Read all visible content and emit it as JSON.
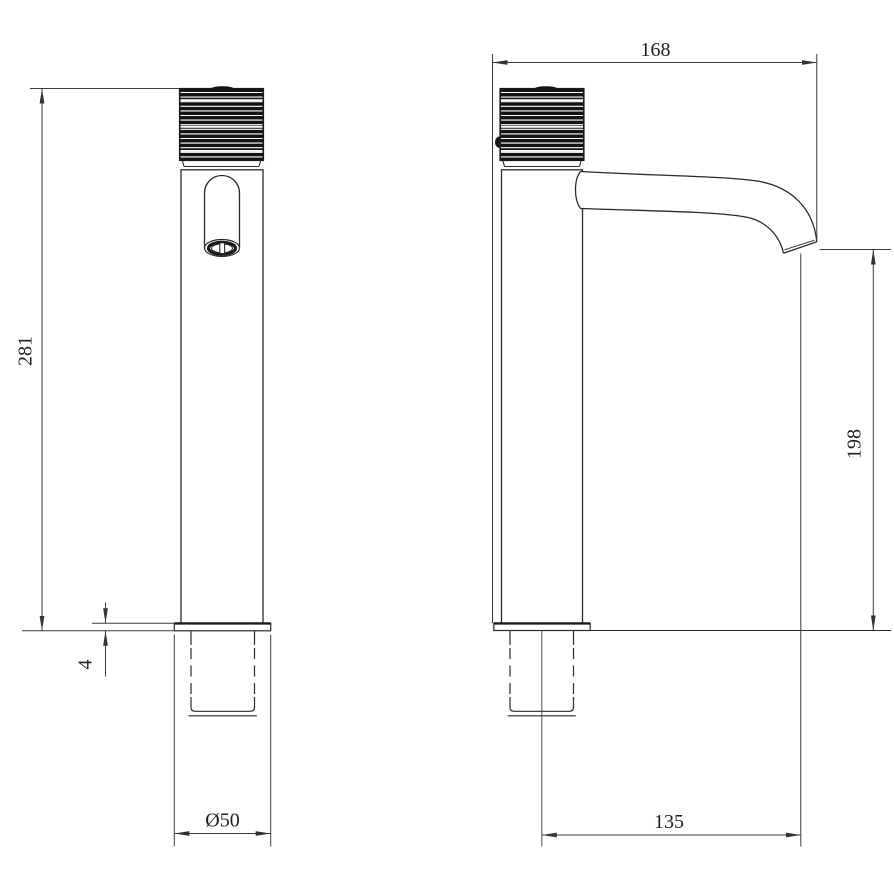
{
  "colors": {
    "background": "#ffffff",
    "object_line": "#2a2a2a",
    "dimension_line": "#3c3c3c",
    "text": "#1f1f1f",
    "knurl_fill": "#141414"
  },
  "front_view": {
    "dim_total_height": "281",
    "dim_base_plate_thickness": "4",
    "dim_base_diameter": "Ø50"
  },
  "side_view": {
    "dim_overall_depth": "168",
    "dim_outlet_height": "198",
    "dim_spout_reach": "135"
  }
}
